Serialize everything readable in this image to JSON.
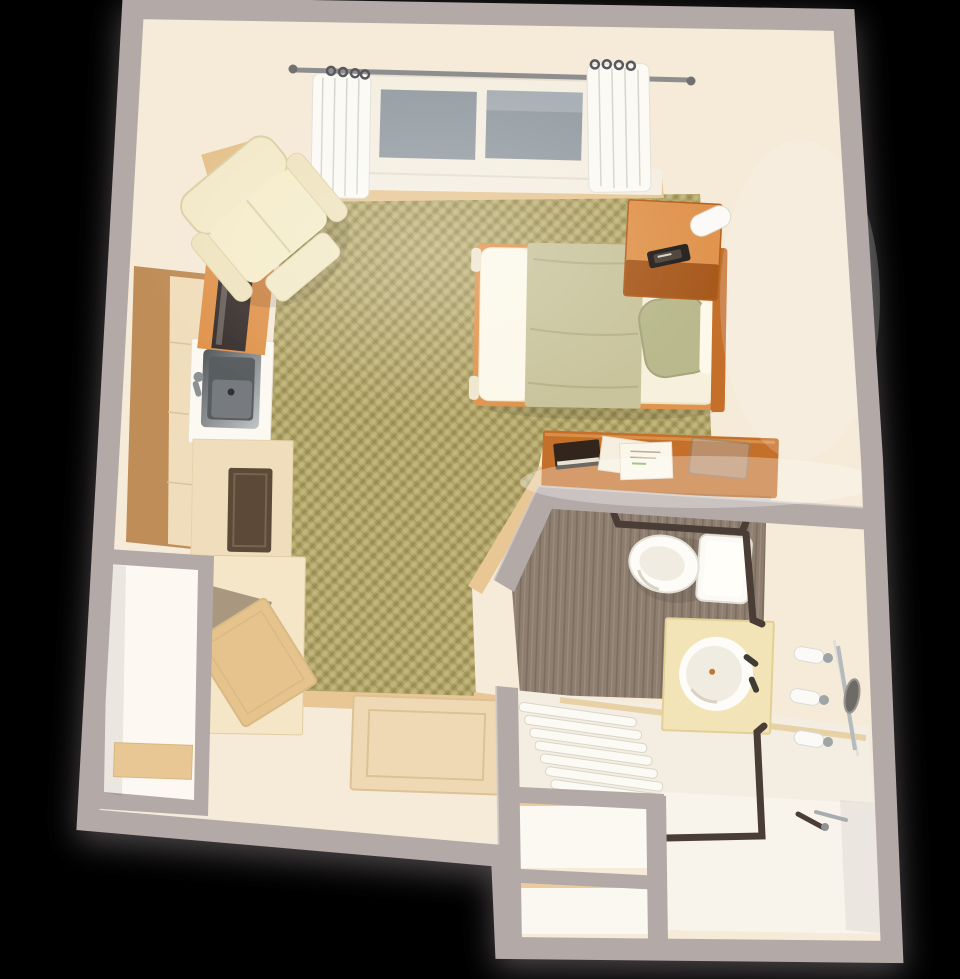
{
  "scene": {
    "title": "Top-down 3D floor plan of a studio apartment",
    "type": "3D rendered floor plan",
    "background": "black"
  },
  "rooms": {
    "main_room": {
      "label": "main living and sleeping area with olive herringbone carpet"
    },
    "kitchenette": {
      "label": "kitchenette along left wall with sink, plant, cabinets and wardrobe"
    },
    "bathroom": {
      "label": "accessible bathroom with toilet, vanity, tub and grab bars"
    },
    "entry": {
      "label": "entry area with door panel"
    },
    "closet": {
      "label": "closet nook with shelf at bottom left"
    }
  },
  "furniture": {
    "bed": "single bed with olive blanket and sage pillow",
    "nightstand": "orange nightstand with lamp and phone",
    "armchair": "cream recliner armchair",
    "tv_console": "wood console with flat TV",
    "side_table": "corner wood side table",
    "desk": "wood desk with papers, book and glass tray",
    "sink_unit": "kitchen sink unit with stainless basin",
    "plant": "green plant with pink blossoms",
    "appliance": "dark appliance front in lower cabinet",
    "wardrobe": "wardrobe with open door",
    "door": "entry door panel laid in plan",
    "window": "double-pane window with curtains and rod",
    "toilet": "toilet with tank",
    "vanity": "vanity with round basin and faucet",
    "vanity_light": "three-bulb vanity light with mirror edge",
    "tub": "tub with slatted bench area",
    "shower": "roll-in shower with grab bars and hand shower",
    "grab_bars": "dark bronze safety grab bars",
    "storage_cubbies": "two white storage cubbies beside shower"
  },
  "colors": {
    "background": "#000000",
    "wall_gray": "#b3a9a7",
    "wall_gray_light": "#d2cac7",
    "floor_cream": "#f6ead8",
    "floor_bright": "#fdf7ec",
    "carpet_base": "#ab9e62",
    "carpet_light": "#ccc088",
    "carpet_dark": "#8b7f45",
    "wood_trim": "#e8c795",
    "counter_tan": "#bf8d58",
    "cabinet_cream": "#f0ddbb",
    "cabinet_wood": "#e6c28c",
    "appliance_dark": "#5b4837",
    "steel_dark": "#54585c",
    "steel_light": "#c2c5c7",
    "orange_wood": "#c4702c",
    "orange_wood_light": "#e0944e",
    "orange_wood_dark": "#a85a1e",
    "tv_dark": "#3a3230",
    "chair_cream": "#f3e9c9",
    "chair_edge": "#ddcfa5",
    "mattress": "#f6f0dc",
    "sheet_white": "#fcf8ea",
    "blanket_olive": "#c9c49c",
    "pillow_sage": "#b9b98d",
    "window_glass": "#98a0a6",
    "window_frame": "#f5efe2",
    "curtain_white": "#fbfaf5",
    "rod_metal": "#8e8e8e",
    "bath_floor_taupe": "#8d7e70",
    "bath_floor_taupe_dark": "#7b6d61",
    "bath_floor_taupe_light": "#9c8d7f",
    "porcelain": "#fdfcf8",
    "porcelain_inner": "#f0ece1",
    "vanity_cream": "#f2e4b6",
    "grab_bar": "#493e35",
    "tub_white": "#f3ede2",
    "shower_white": "#f8f4ec",
    "plant_green": "#58a832",
    "plant_green_light": "#7cc24e",
    "plant_pink": "#d893c0"
  }
}
